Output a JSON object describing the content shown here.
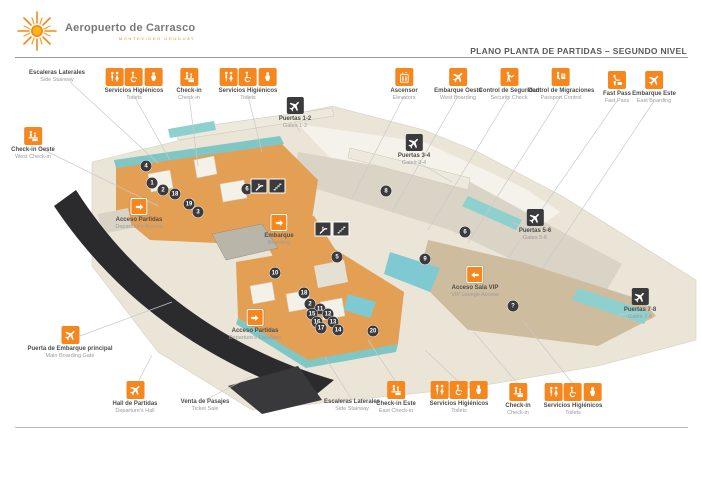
{
  "header": {
    "logo_title": "Aeropuerto de Carrasco",
    "logo_subtitle": "MONTEVIDEO URUGUAY",
    "page_title": "PLANO PLANTA DE PARTIDAS – SEGUNDO NIVEL"
  },
  "colors": {
    "accent_orange": "#F5871E",
    "dark_box": "#3B3B3D",
    "floor_orange": "#E3A055",
    "teal": "#7FC6C4",
    "cream": "#EAE5D7",
    "canopy_dark": "#2B2B2D",
    "label_dark": "#4D4D4F",
    "label_gray": "#9B9B9D"
  },
  "callouts": [
    {
      "id": "escaleras-laterales-oeste",
      "es": "Escaleras Laterales",
      "en": "Side Stairway",
      "icons": [],
      "style": "text",
      "cx": 57,
      "top": 70
    },
    {
      "id": "servicios-higienicos-noroeste",
      "es": "Servicios Higiénicos",
      "en": "Toilets",
      "icons": [
        "restroom-icon",
        "wheelchair-icon",
        "baby-icon"
      ],
      "style": "orange",
      "cx": 134,
      "top": 68
    },
    {
      "id": "check-in-norte",
      "es": "Check-in",
      "en": "Check-in",
      "icons": [
        "checkin-icon"
      ],
      "style": "orange",
      "cx": 189,
      "top": 68
    },
    {
      "id": "servicios-higienicos-norte",
      "es": "Servicios Higiénicos",
      "en": "Toilets",
      "icons": [
        "restroom-icon",
        "wheelchair-icon",
        "baby-icon"
      ],
      "style": "orange",
      "cx": 248,
      "top": 68
    },
    {
      "id": "puertas-1-2",
      "es": "Puertas 1-2",
      "en": "Gates 1-2",
      "icons": [
        "plane-icon"
      ],
      "style": "dark",
      "cx": 295,
      "top": 97
    },
    {
      "id": "ascensor",
      "es": "Ascensor",
      "en": "Elevators",
      "icons": [
        "elevator-icon"
      ],
      "style": "orange",
      "cx": 404,
      "top": 68
    },
    {
      "id": "embarque-oeste",
      "es": "Embarque Oeste",
      "en": "West Boarding",
      "icons": [
        "plane-icon"
      ],
      "style": "orange",
      "cx": 458,
      "top": 68
    },
    {
      "id": "control-de-seguridad",
      "es": "Control de Seguridad",
      "en": "Security Check",
      "icons": [
        "security-icon"
      ],
      "style": "orange",
      "cx": 509,
      "top": 68
    },
    {
      "id": "control-de-migraciones",
      "es": "Control de Migraciones",
      "en": "Passport Control",
      "icons": [
        "passport-icon"
      ],
      "style": "orange",
      "cx": 561,
      "top": 68
    },
    {
      "id": "fast-pass",
      "es": "Fast Pass",
      "en": "Fast Pass",
      "icons": [
        "fastpass-icon"
      ],
      "style": "orange",
      "cx": 617,
      "top": 71
    },
    {
      "id": "embarque-este",
      "es": "Embarque Este",
      "en": "East Boarding",
      "icons": [
        "plane-icon"
      ],
      "style": "orange",
      "cx": 654,
      "top": 71
    },
    {
      "id": "check-in-oeste",
      "es": "Check-in Oeste",
      "en": "West Check-in",
      "icons": [
        "checkin-icon"
      ],
      "style": "orange",
      "cx": 33,
      "top": 127
    },
    {
      "id": "acceso-partidas-oeste",
      "es": "Acceso Partidas",
      "en": "Departure's Access",
      "icons": [
        "arrow-right-icon"
      ],
      "style": "arrow",
      "cx": 139,
      "top": 198
    },
    {
      "id": "embarque-centro",
      "es": "Embarque",
      "en": "Boarding",
      "icons": [
        "arrow-right-icon"
      ],
      "style": "arrow",
      "cx": 279,
      "top": 214
    },
    {
      "id": "puertas-3-4",
      "es": "Puertas 3-4",
      "en": "Gates 3-4",
      "icons": [
        "plane-icon"
      ],
      "style": "dark",
      "cx": 414,
      "top": 134
    },
    {
      "id": "puertas-5-6",
      "es": "Puertas 5-6",
      "en": "Gates 5-6",
      "icons": [
        "plane-icon"
      ],
      "style": "dark",
      "cx": 535,
      "top": 209
    },
    {
      "id": "puertas-7-8",
      "es": "Puertas 7-8",
      "en": "Gates 7-8",
      "icons": [
        "plane-icon"
      ],
      "style": "dark",
      "cx": 640,
      "top": 288
    },
    {
      "id": "acceso-sala-vip",
      "es": "Acceso Sala VIP",
      "en": "VIP Lounge Access",
      "icons": [
        "arrow-left-icon"
      ],
      "style": "arrow",
      "cx": 475,
      "top": 266
    },
    {
      "id": "puerta-embarque-principal",
      "es": "Puerta de Embarque principal",
      "en": "Main Boarding Gate",
      "icons": [
        "plane-icon"
      ],
      "style": "orange",
      "cx": 70,
      "top": 326
    },
    {
      "id": "acceso-partidas-sur",
      "es": "Acceso Partidas",
      "en": "Departure's Escalator",
      "icons": [
        "arrow-right-icon"
      ],
      "style": "arrow",
      "cx": 255,
      "top": 309
    },
    {
      "id": "hall-de-partidas",
      "es": "Hall de Partidas",
      "en": "Departure's Hall",
      "icons": [
        "plane-icon"
      ],
      "style": "orange",
      "cx": 135,
      "top": 381
    },
    {
      "id": "venta-de-pasajes",
      "es": "Venta de Pasajes",
      "en": "Ticket Sale",
      "icons": [],
      "style": "text",
      "cx": 205,
      "top": 399
    },
    {
      "id": "escaleras-laterales-este",
      "es": "Escaleras Laterales",
      "en": "Side Stairway",
      "icons": [],
      "style": "text",
      "cx": 352,
      "top": 399
    },
    {
      "id": "check-in-este",
      "es": "Check-in Este",
      "en": "East Check-in",
      "icons": [
        "checkin-icon"
      ],
      "style": "orange",
      "cx": 396,
      "top": 381
    },
    {
      "id": "servicios-higienicos-sureste-1",
      "es": "Servicios Higiénicos",
      "en": "Toilets",
      "icons": [
        "restroom-icon",
        "wheelchair-icon",
        "baby-icon"
      ],
      "style": "orange",
      "cx": 459,
      "top": 381
    },
    {
      "id": "check-in-sur",
      "es": "Check-in",
      "en": "Check-in",
      "icons": [
        "checkin-icon"
      ],
      "style": "orange",
      "cx": 518,
      "top": 383
    },
    {
      "id": "servicios-higienicos-sureste-2",
      "es": "Servicios Higiénicos",
      "en": "Toilets",
      "icons": [
        "restroom-icon",
        "wheelchair-icon",
        "baby-icon"
      ],
      "style": "orange",
      "cx": 573,
      "top": 383
    }
  ],
  "markers": [
    {
      "n": "4",
      "x": 146,
      "y": 166
    },
    {
      "n": "1",
      "x": 152,
      "y": 183
    },
    {
      "n": "2",
      "x": 163,
      "y": 190
    },
    {
      "n": "18",
      "x": 175,
      "y": 194
    },
    {
      "n": "19",
      "x": 189,
      "y": 204
    },
    {
      "n": "3",
      "x": 198,
      "y": 212
    },
    {
      "n": "6",
      "x": 247,
      "y": 189
    },
    {
      "n": "8",
      "x": 386,
      "y": 191
    },
    {
      "n": "5",
      "x": 337,
      "y": 257
    },
    {
      "n": "9",
      "x": 425,
      "y": 259
    },
    {
      "n": "6",
      "x": 465,
      "y": 232
    },
    {
      "n": "10",
      "x": 275,
      "y": 273
    },
    {
      "n": "18",
      "x": 304,
      "y": 293
    },
    {
      "n": "2",
      "x": 310,
      "y": 304
    },
    {
      "n": "11",
      "x": 320,
      "y": 309
    },
    {
      "n": "15",
      "x": 312,
      "y": 314
    },
    {
      "n": "12",
      "x": 328,
      "y": 314
    },
    {
      "n": "16",
      "x": 317,
      "y": 322
    },
    {
      "n": "13",
      "x": 333,
      "y": 322
    },
    {
      "n": "17",
      "x": 321,
      "y": 328
    },
    {
      "n": "14",
      "x": 338,
      "y": 330
    },
    {
      "n": "20",
      "x": 373,
      "y": 331
    },
    {
      "n": "?",
      "x": 513,
      "y": 306
    }
  ],
  "map_badges": [
    {
      "icon": "escalator-icon",
      "x": 259,
      "y": 186
    },
    {
      "icon": "stairs-icon",
      "x": 277,
      "y": 186
    },
    {
      "icon": "escalator-icon",
      "x": 323,
      "y": 229
    },
    {
      "icon": "stairs-icon",
      "x": 341,
      "y": 229
    }
  ]
}
